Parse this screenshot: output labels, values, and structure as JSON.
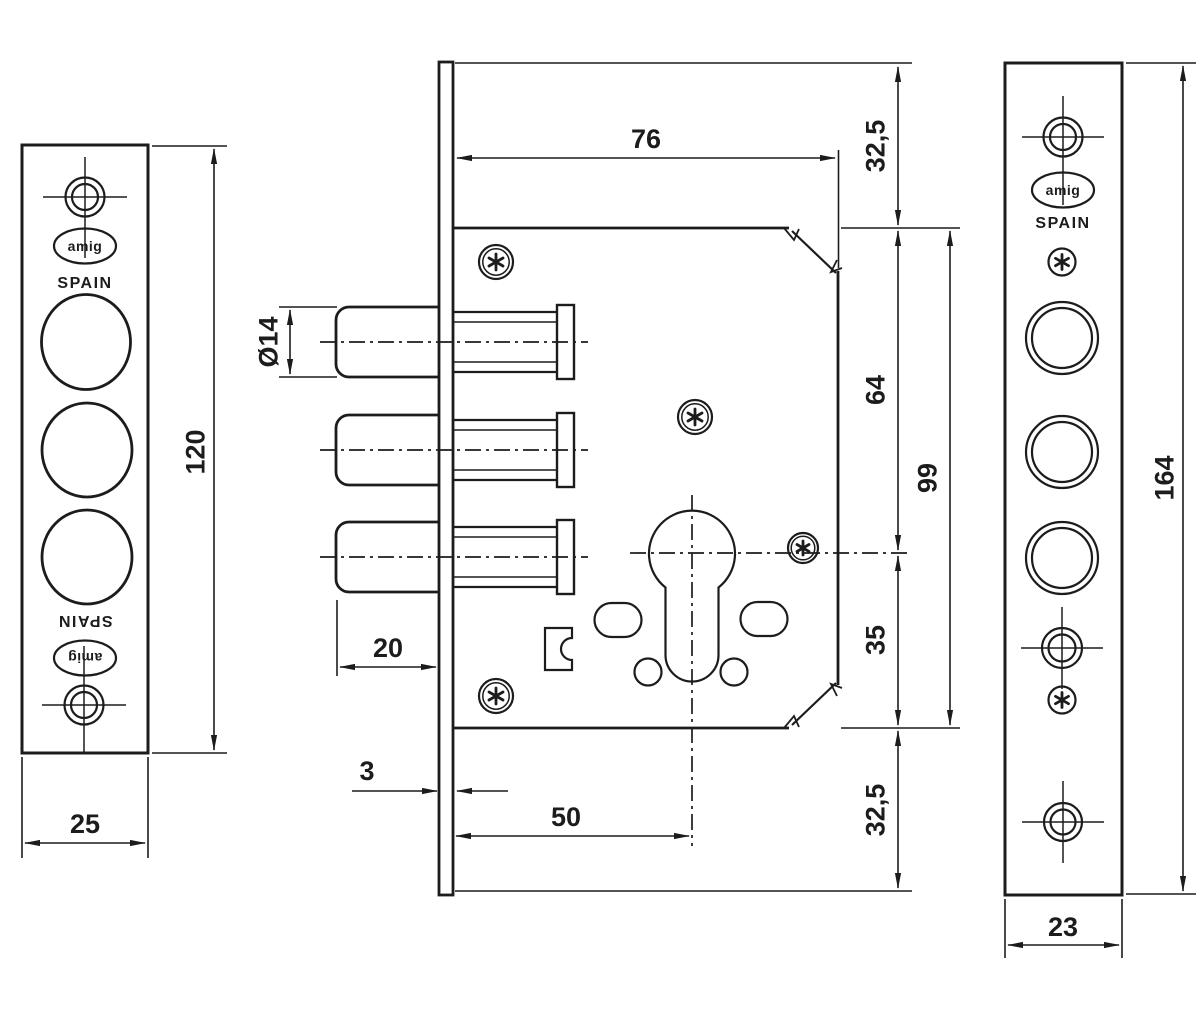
{
  "colors": {
    "ink": "#1c1c1c",
    "paper": "#ffffff"
  },
  "brand": {
    "logo_text": "amig",
    "country_label": "SPAIN"
  },
  "icons": {
    "screw_head": "torx-star-circle-icon",
    "screw_hole": "crosshair-target-icon",
    "brand_badge": "ellipse-outline-badge"
  },
  "left_view": {
    "height_label": "120",
    "width_label": "25"
  },
  "body_view": {
    "width_label": "76",
    "top_offset_label": "32,5",
    "upper_span_label": "64",
    "overall_span_label": "99",
    "lower_span_label": "35",
    "bottom_offset_label": "32,5",
    "bolt_diameter_label": "Ø14",
    "bolt_length_label": "20",
    "plate_thickness_label": "3",
    "backset_label": "50"
  },
  "right_view": {
    "height_label": "164",
    "width_label": "23"
  }
}
